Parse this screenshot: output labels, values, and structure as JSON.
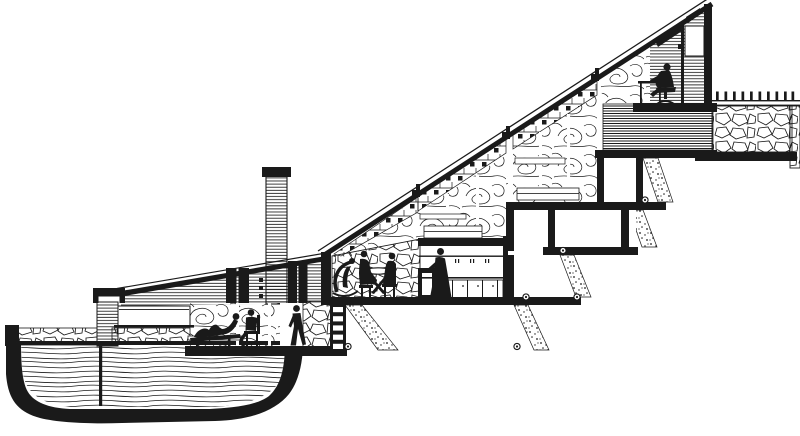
{
  "page": {
    "background": "#ffffff"
  },
  "colors": {
    "ink": "#1a1a1a",
    "paper": "#ffffff"
  },
  "drawing": {
    "label": "Cross-section drawing of a stepped hillside house descending to a pool",
    "level_count": 5,
    "railing_post_count": 10,
    "figures": [
      "person-reclining-on-chaise",
      "person-seated-on-chair",
      "person-walking",
      "person-in-lounge-chair",
      "person-at-table-left",
      "person-at-table-right",
      "person-standing-at-counter",
      "person-seated-at-desk"
    ],
    "features": [
      "pool-basin-section",
      "stone-garden-wall",
      "clerestory-window",
      "chimney",
      "dining-stone-wall",
      "kitchen-counter",
      "stepped-foundation-piers",
      "roof-terrace-railing",
      "stone-retaining-wall",
      "study-under-roof-peak"
    ]
  }
}
